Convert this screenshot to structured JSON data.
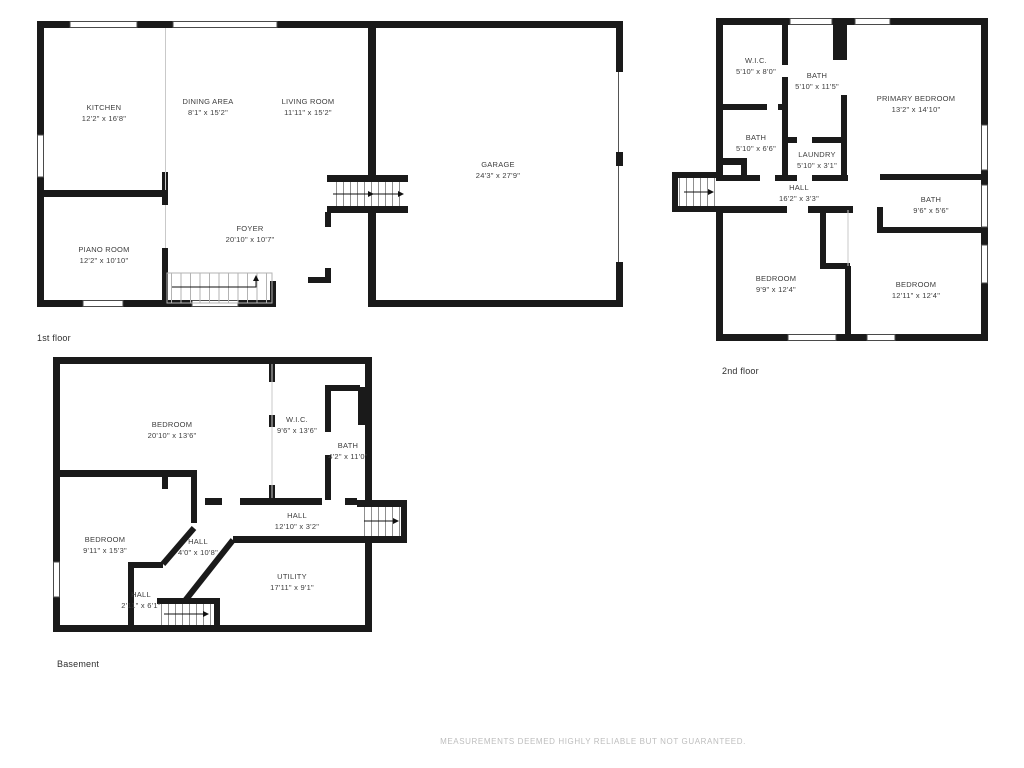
{
  "floors": {
    "first": {
      "label": "1st floor",
      "rooms": {
        "kitchen": {
          "name": "KITCHEN",
          "dims": "12'2\" x 16'8\""
        },
        "dining": {
          "name": "DINING AREA",
          "dims": "8'1\" x 15'2\""
        },
        "living": {
          "name": "LIVING ROOM",
          "dims": "11'11\" x 15'2\""
        },
        "garage": {
          "name": "GARAGE",
          "dims": "24'3\" x 27'9\""
        },
        "foyer": {
          "name": "FOYER",
          "dims": "20'10\" x 10'7\""
        },
        "piano": {
          "name": "PIANO ROOM",
          "dims": "12'2\" x 10'10\""
        }
      }
    },
    "second": {
      "label": "2nd floor",
      "rooms": {
        "wic": {
          "name": "W.I.C.",
          "dims": "5'10\" x 8'0\""
        },
        "bath_mid": {
          "name": "BATH",
          "dims": "5'10\" x 11'5\""
        },
        "primary": {
          "name": "PRIMARY BEDROOM",
          "dims": "13'2\" x 14'10\""
        },
        "bath_left": {
          "name": "BATH",
          "dims": "5'10\" x 6'6\""
        },
        "laundry": {
          "name": "LAUNDRY",
          "dims": "5'10\" x 3'1\""
        },
        "hall": {
          "name": "HALL",
          "dims": "16'2\" x 3'3\""
        },
        "bath_right": {
          "name": "BATH",
          "dims": "9'6\" x 5'6\""
        },
        "bedroom_left": {
          "name": "BEDROOM",
          "dims": "9'9\" x 12'4\""
        },
        "bedroom_right": {
          "name": "BEDROOM",
          "dims": "12'11\" x 12'4\""
        }
      }
    },
    "basement": {
      "label": "Basement",
      "rooms": {
        "bedroom_top": {
          "name": "BEDROOM",
          "dims": "20'10\" x 13'6\""
        },
        "wic": {
          "name": "W.I.C.",
          "dims": "9'6\" x 13'6\""
        },
        "bath": {
          "name": "BATH",
          "dims": "4'2\" x 11'0\""
        },
        "hall_main": {
          "name": "HALL",
          "dims": "12'10\" x 3'2\""
        },
        "bedroom_bottom": {
          "name": "BEDROOM",
          "dims": "9'11\" x 15'3\""
        },
        "hall_diag": {
          "name": "HALL",
          "dims": "4'0\" x 10'8\""
        },
        "hall_small": {
          "name": "HALL",
          "dims": "2'11\" x 6'1\""
        },
        "utility": {
          "name": "UTILITY",
          "dims": "17'11\" x 9'1\""
        }
      }
    }
  },
  "footer": {
    "disclaimer": "MEASUREMENTS DEEMED HIGHLY RELIABLE BUT NOT GUARANTEED."
  },
  "colors": {
    "wall": "#1a1a1a",
    "label_text": "#3d3d3d",
    "footer_text": "#bdbdbd",
    "background": "#ffffff"
  }
}
